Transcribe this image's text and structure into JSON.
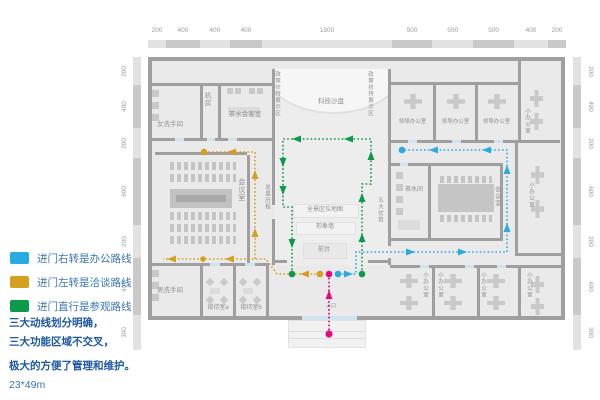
{
  "colors": {
    "route_office_blue": "#29abe2",
    "route_talk_yellow": "#d5a021",
    "route_tour_green": "#0a9a4a",
    "route_entry_magenta": "#e6087e",
    "legend_text": "#3a74b5",
    "note_text": "#1d57a5"
  },
  "legend": {
    "items": [
      {
        "id": "office",
        "label": "进门右转是办公路线"
      },
      {
        "id": "talk",
        "label": "进门左转是洽谈路线"
      },
      {
        "id": "tour",
        "label": "进门直行是参观路线"
      }
    ]
  },
  "notes": {
    "lines": [
      "三大动线划分明确，",
      "三大功能区域不交叉，",
      "极大的方便了管理和维护。"
    ],
    "dimensions": "23*49m"
  },
  "rulers": {
    "top": [
      "200",
      "400",
      "400",
      "400",
      "1500",
      "500",
      "500",
      "500",
      "400",
      "200"
    ],
    "left": [
      "200",
      "400",
      "200",
      "600",
      "200",
      "400",
      "300"
    ],
    "right": [
      "200",
      "400",
      "200",
      "600",
      "200",
      "400",
      "300"
    ]
  },
  "rooms": {
    "women_restroom": "女洗手间",
    "machine_room": "机房",
    "tea_reception": "茶水会客室",
    "tech_sandbox": "科技沙盘",
    "policy_wall": "政策扶持展示区",
    "meeting_room": "会议室",
    "history_wall": "发展历程",
    "panorama_map": "全景区位地图",
    "image_wall": "形象墙",
    "front_desk": "前台",
    "advantages_wall": "五大优势",
    "tea_room": "茶水间",
    "leader_office": "领导办公室",
    "small_office": "小办公室",
    "men_restroom": "男洗手间",
    "reception_a": "接待室a",
    "reception_b": "接待室b",
    "entrance": "入口"
  }
}
